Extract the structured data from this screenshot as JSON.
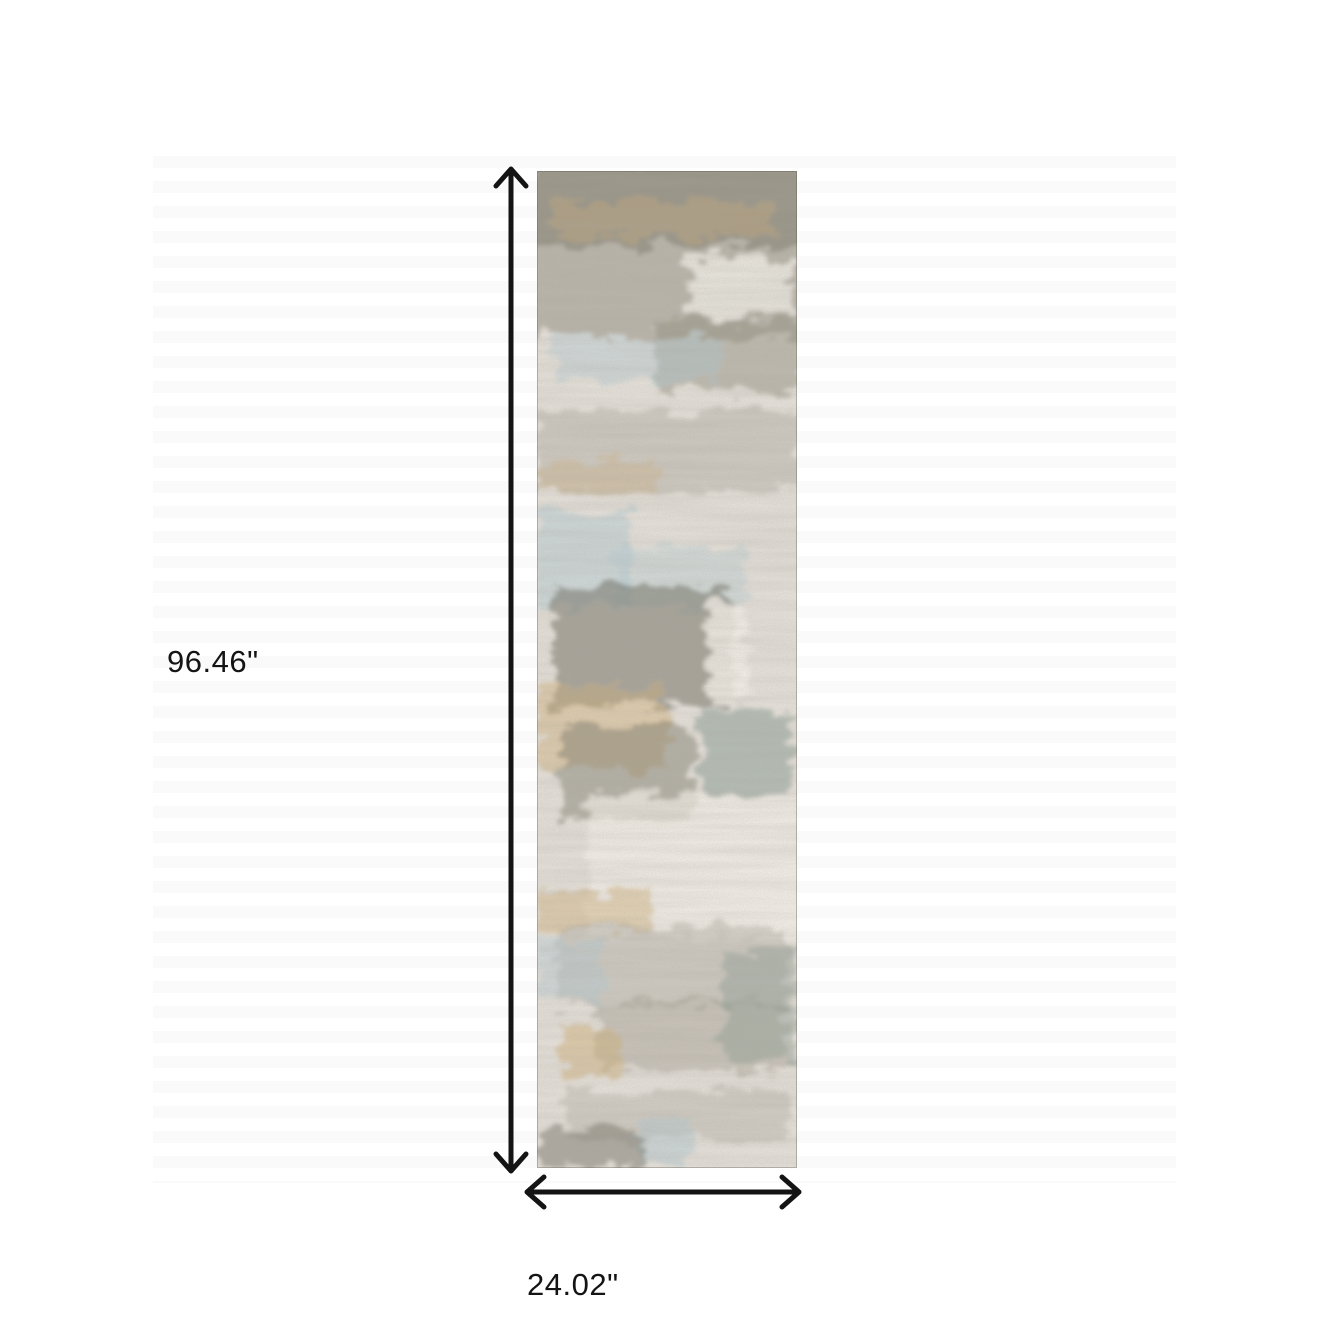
{
  "figure": {
    "type": "product-dimension-diagram",
    "subject": "Abstract distressed gray, blue and gold runner rug shown from above",
    "height_label": "96.46\"",
    "width_label": "24.02\"",
    "arrow_color": "#141414",
    "label_color": "#141414",
    "background_color": "#ffffff"
  },
  "rug": {
    "orientation": "vertical runner",
    "palette": {
      "base": "#e4dfd8",
      "dark": "#68665a",
      "olive": "#8f8a7a",
      "gray": "#a09b90",
      "blue": "#afc8d1",
      "teal": "#84988f",
      "gold": "#d1b077",
      "cream": "#f3efe8",
      "edge": "rgba(90,85,75,0.35)"
    }
  }
}
